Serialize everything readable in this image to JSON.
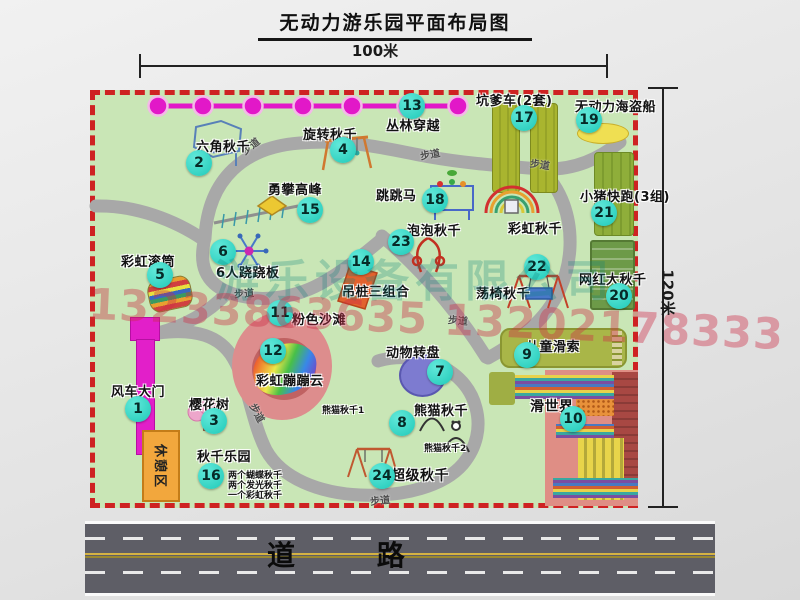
{
  "title": "无动力游乐园平面布局图",
  "dimension_labels": {
    "top": "100米",
    "right": "120米"
  },
  "road_label": "道 路",
  "rest_area_label": "休憩区",
  "walkway_label": "步道",
  "rainbow_swing_label": "彩虹秋千",
  "watermark": {
    "company": "游乐设备有限公司",
    "phone": "13233863635 13202178333"
  },
  "attractions": [
    {
      "num": "1",
      "label": "风车大门"
    },
    {
      "num": "2",
      "label": "六角秋千"
    },
    {
      "num": "3",
      "label": "樱花树"
    },
    {
      "num": "4",
      "label": "旋转秋千"
    },
    {
      "num": "5",
      "label": "彩虹滚筒"
    },
    {
      "num": "6",
      "label": "6人跷跷板"
    },
    {
      "num": "7",
      "label": "动物转盘"
    },
    {
      "num": "8",
      "label": "熊猫秋千",
      "sub": [
        "熊猫秋千1",
        "熊猫秋千2"
      ]
    },
    {
      "num": "9",
      "label": "儿童滑索"
    },
    {
      "num": "10",
      "label": "滑世界"
    },
    {
      "num": "11",
      "label": "粉色沙滩"
    },
    {
      "num": "12",
      "label": "彩虹蹦蹦云"
    },
    {
      "num": "13",
      "label": "丛林穿越"
    },
    {
      "num": "14",
      "label": "吊桩三组合"
    },
    {
      "num": "15",
      "label": "勇攀高峰"
    },
    {
      "num": "16",
      "label": "秋千乐园",
      "sub": [
        "两个蝴蝶秋千",
        "两个发光秋千",
        "一个彩虹秋千"
      ]
    },
    {
      "num": "17",
      "label": "坑爹车(2套)"
    },
    {
      "num": "18",
      "label": "跳跳马"
    },
    {
      "num": "19",
      "label": "无动力海盗船"
    },
    {
      "num": "20",
      "label": "网红大秋千"
    },
    {
      "num": "21",
      "label": "小猪快跑(3组)"
    },
    {
      "num": "22",
      "label": "荡椅秋千"
    },
    {
      "num": "23",
      "label": "泡泡秋千"
    },
    {
      "num": "24",
      "label": "超级秋千"
    }
  ],
  "colors": {
    "park_green": "#c9e6b6",
    "border_red": "#ce2222",
    "marker_teal": "#1fc9b8",
    "zipline_magenta": "#e218c8",
    "gate_magenta": "#e21fc9",
    "rest_orange": "#f2a73d",
    "road_gray": "#5e5e66",
    "path_gray": "#a8a8a8"
  }
}
